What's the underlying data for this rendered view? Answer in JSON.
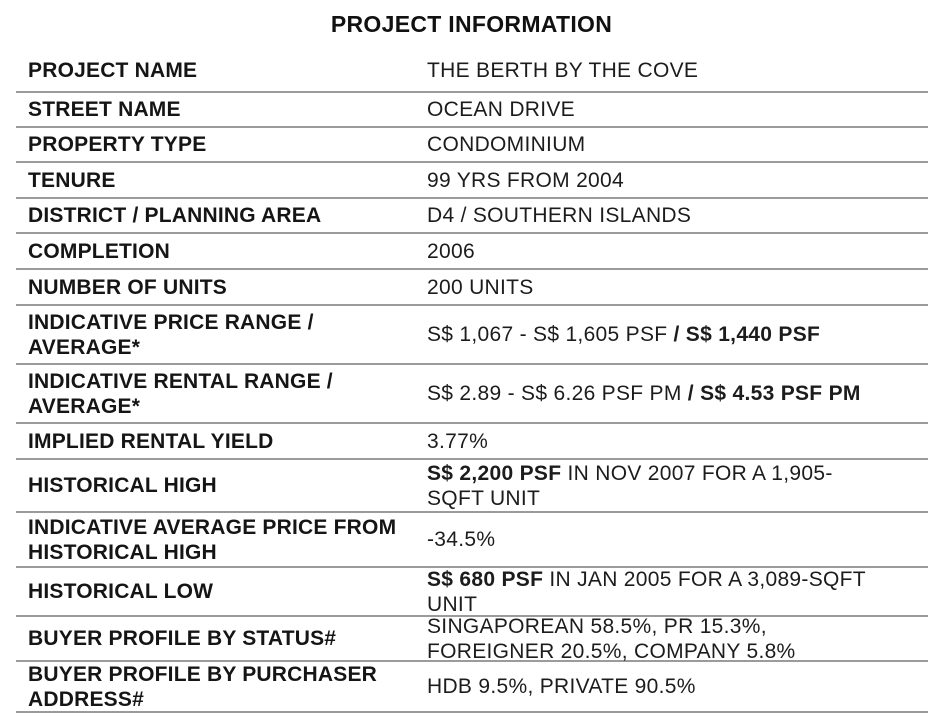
{
  "page": {
    "background": "#ffffff",
    "text_color": "#1a1a1a",
    "line_color": "#9b9b9b"
  },
  "title": "PROJECT INFORMATION",
  "table": {
    "rows": [
      {
        "label": "PROJECT NAME",
        "value": "THE BERTH BY THE COVE"
      },
      {
        "label": "STREET NAME",
        "value": "OCEAN DRIVE"
      },
      {
        "label": "PROPERTY TYPE",
        "value": "CONDOMINIUM"
      },
      {
        "label": "TENURE",
        "value": "99 YRS FROM 2004"
      },
      {
        "label": "DISTRICT / PLANNING AREA",
        "value": "D4 / SOUTHERN ISLANDS"
      },
      {
        "label": "COMPLETION",
        "value": "2006"
      },
      {
        "label": "NUMBER OF UNITS",
        "value": "200 UNITS"
      },
      {
        "label": "INDICATIVE PRICE RANGE / AVERAGE*",
        "value_normal": "S$ 1,067 - S$ 1,605 PSF ",
        "value_bold": "/ S$ 1,440 PSF"
      },
      {
        "label": "INDICATIVE RENTAL RANGE / AVERAGE*",
        "value_normal": "S$ 2.89 - S$ 6.26 PSF PM ",
        "value_bold": "/ S$ 4.53 PSF PM"
      },
      {
        "label": "IMPLIED RENTAL YIELD",
        "value": "3.77%"
      },
      {
        "label": "HISTORICAL HIGH",
        "value_bold": "S$ 2,200 PSF",
        "value_line1_rest": " IN NOV 2007 FOR A 1,905-",
        "value_line2": "SQFT UNIT"
      },
      {
        "label": "INDICATIVE AVERAGE PRICE FROM HISTORICAL HIGH",
        "value": "-34.5%"
      },
      {
        "label": "HISTORICAL LOW",
        "value_bold": "S$ 680 PSF",
        "value_line1_rest": " IN JAN 2005 FOR A 3,089-SQFT",
        "value_line2": "UNIT"
      },
      {
        "label": "BUYER PROFILE BY STATUS#",
        "value_line1": "SINGAPOREAN 58.5%, PR 15.3%,",
        "value_line2": "FOREIGNER 20.5%, COMPANY 5.8%"
      },
      {
        "label": "BUYER PROFILE BY PURCHASER ADDRESS#",
        "value": "HDB 9.5%, PRIVATE 90.5%"
      }
    ]
  }
}
